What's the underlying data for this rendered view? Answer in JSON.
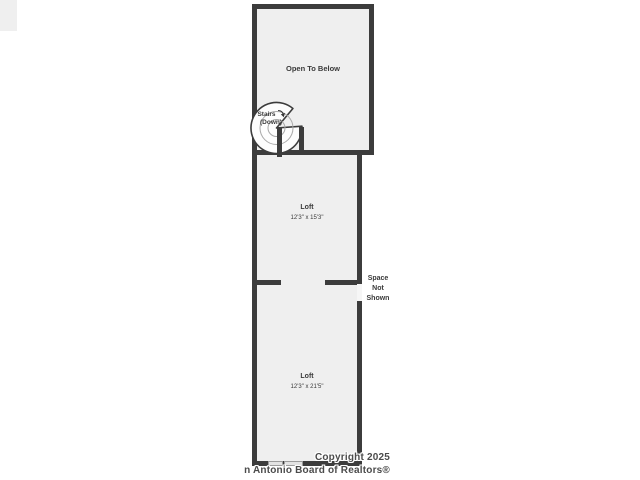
{
  "colors": {
    "wall": "#3c3c3c",
    "room_fill": "#efefef",
    "window_fill": "#e3e3e3",
    "label_text": "#3a3a3a",
    "copyright_text": "#4b4b4b"
  },
  "floorplan": {
    "open_to_below": {
      "label": "Open To Below"
    },
    "stairs": {
      "line1": "Stairs",
      "line2": "(Down)"
    },
    "loft_upper": {
      "name": "Loft",
      "dims": "12'3\" x 15'3\""
    },
    "loft_lower": {
      "name": "Loft",
      "dims": "12'3\" x 21'5\""
    },
    "space_not_shown": {
      "line1": "Space",
      "line2": "Not",
      "line3": "Shown"
    },
    "copyright": {
      "line1": "Copyright 2025",
      "line2": "n Antonio Board of Realtors®"
    }
  }
}
